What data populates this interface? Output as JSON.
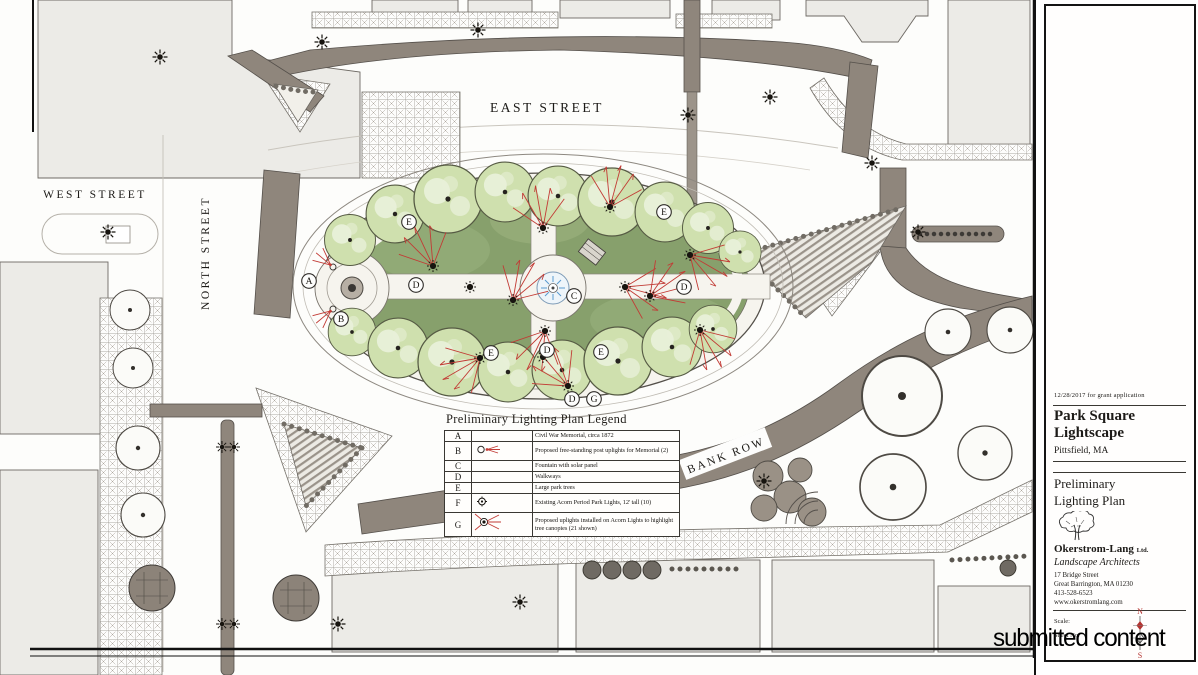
{
  "meta": {
    "watermark": "submitted content"
  },
  "plan": {
    "streets": {
      "east": "EAST STREET",
      "west": "WEST STREET",
      "north": "NORTH STREET",
      "bank_row": "BANK ROW"
    },
    "markers": [
      {
        "letter": "A",
        "role": "civil-war-memorial"
      },
      {
        "letter": "B",
        "role": "memorial-uplights"
      },
      {
        "letter": "C",
        "role": "fountain"
      },
      {
        "letter": "D",
        "role": "walkway"
      },
      {
        "letter": "D",
        "role": "walkway"
      },
      {
        "letter": "D",
        "role": "walkway"
      },
      {
        "letter": "D",
        "role": "walkway"
      },
      {
        "letter": "G",
        "role": "acorn-uplight"
      },
      {
        "letter": "E",
        "role": "park-tree"
      },
      {
        "letter": "E",
        "role": "park-tree"
      },
      {
        "letter": "E",
        "role": "park-tree"
      },
      {
        "letter": "E",
        "role": "park-tree"
      }
    ],
    "colors": {
      "road": "#8f867c",
      "building": "#ecebe7",
      "grass": "#87a06c",
      "tree": "#cfe0ae",
      "water": "#5b9bd0",
      "uplight_red": "#c23b35",
      "ink": "#2e2b28"
    }
  },
  "legend": {
    "title": "Preliminary Lighting Plan Legend",
    "rows": [
      {
        "letter": "A",
        "symbol": "none",
        "text": "Civil War Memorial, circa 1872"
      },
      {
        "letter": "B",
        "symbol": "post-uplight",
        "text": "Proposed free-standing post uplights for Memorial (2)"
      },
      {
        "letter": "C",
        "symbol": "none",
        "text": "Fountain with solar panel"
      },
      {
        "letter": "D",
        "symbol": "none",
        "text": "Walkways"
      },
      {
        "letter": "E",
        "symbol": "none",
        "text": "Large park trees"
      },
      {
        "letter": "F",
        "symbol": "acorn-light",
        "text": "Existing Acorn Period Park Lights, 12' tall (10)"
      },
      {
        "letter": "G",
        "symbol": "acorn-uplight",
        "text": "Proposed uplights installed on Acorn Lights to highlight tree canopies (21 shown)"
      }
    ]
  },
  "title_block": {
    "date_note": "12/28/2017  for grant application",
    "project_title_line1": "Park Square",
    "project_title_line2": "Lightscape",
    "location": "Pittsfield, MA",
    "sheet_title_line1": "Preliminary",
    "sheet_title_line2": "Lighting Plan",
    "firm_name": "Okerstrom-Lang",
    "firm_suffix": "Ltd.",
    "firm_subtitle": "Landscape Architects",
    "address_line1": "17 Bridge Street",
    "address_line2": "Great Barrington, MA 01230",
    "phone": "413-528-6523",
    "website": "www.okerstromlang.com",
    "scale_label": "Scale:",
    "sheet_no_label": "Sheet No.",
    "compass_north": "N",
    "compass_south": "S"
  }
}
